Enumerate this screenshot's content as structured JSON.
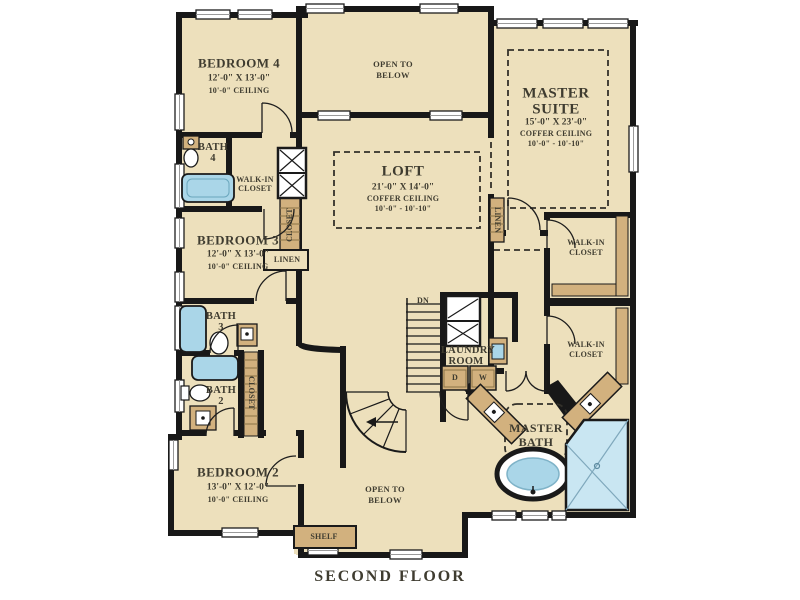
{
  "plan": {
    "title": "SECOND FLOOR",
    "rooms": {
      "bedroom4": {
        "name": "BEDROOM 4",
        "dims": "12'-0\" X 13'-0\"",
        "ceiling": "10'-0\" CEILING"
      },
      "bedroom3": {
        "name": "BEDROOM 3",
        "dims": "12'-0\" X 13'-0\"",
        "ceiling": "10'-0\" CEILING"
      },
      "bedroom2": {
        "name": "BEDROOM 2",
        "dims": "13'-0\" X 12'-0\"",
        "ceiling": "10'-0\" CEILING"
      },
      "master_suite": {
        "name1": "MASTER",
        "name2": "SUITE",
        "dims": "15'-0\" X 23'-0\"",
        "ceiling_type": "COFFER CEILING",
        "ceiling_hts": "10'-0\" - 10'-10\""
      },
      "loft": {
        "name": "LOFT",
        "dims": "21'-0\" X 14'-0\"",
        "ceiling_type": "COFFER CEILING",
        "ceiling_hts": "10'-0\" - 10'-10\""
      },
      "master_bath": {
        "name1": "MASTER",
        "name2": "BATH"
      },
      "bath4": {
        "name1": "BATH",
        "name2": "4"
      },
      "bath3": {
        "name1": "BATH",
        "name2": "3"
      },
      "bath2": {
        "name1": "BATH",
        "name2": "2"
      },
      "laundry": {
        "name1": "LAUNDRY",
        "name2": "ROOM",
        "dryer": "D",
        "washer": "W"
      }
    },
    "labels": {
      "open_to_below1": "OPEN TO",
      "open_to_below2": "BELOW",
      "walk_in1": "WALK-IN",
      "walk_in2": "CLOSET",
      "linen": "LINEN",
      "closet": "CLOSET",
      "shelf": "SHELF",
      "stairs_down": "DN"
    },
    "colors": {
      "background": "#FFFFFF",
      "floor": "#EDE0BC",
      "wall": "#181818",
      "fixture_blue": "#AAD6E8",
      "shower_blue": "#C9E6F2",
      "cabinet_tan": "#D2B17E",
      "text": "#3F3C30"
    }
  }
}
